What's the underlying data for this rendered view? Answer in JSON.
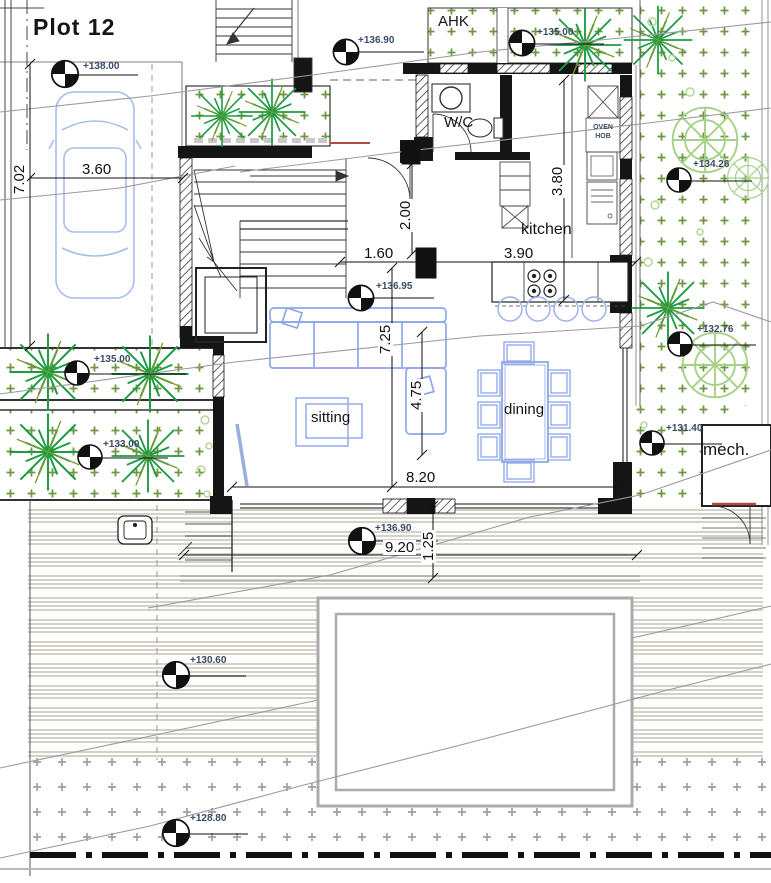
{
  "title": "Plot 12",
  "rooms": {
    "ahk": "AHK",
    "wc": "W/C",
    "kitchen": "kitchen",
    "sitting": "sitting",
    "dining": "dining",
    "mech": "mech."
  },
  "appliance_labels": {
    "oven": "OVEN",
    "hob": "HOB"
  },
  "elevation_markers": [
    {
      "id": "garage",
      "value": "+138.00"
    },
    {
      "id": "entry-court",
      "value": "+136.90"
    },
    {
      "id": "ahk-court",
      "value": "+135.00"
    },
    {
      "id": "living",
      "value": "+136.95"
    },
    {
      "id": "garden-east-upper",
      "value": "+134.26"
    },
    {
      "id": "garden-east-mid",
      "value": "+132.76"
    },
    {
      "id": "mech-yard",
      "value": "+131.40"
    },
    {
      "id": "garden-west-upper",
      "value": "+135.00"
    },
    {
      "id": "garden-west-lower",
      "value": "+133.00"
    },
    {
      "id": "terrace",
      "value": "+136.90"
    },
    {
      "id": "lawn",
      "value": "+130.60"
    },
    {
      "id": "garden-south",
      "value": "+128.80"
    }
  ],
  "dimensions": [
    {
      "id": "plot-side",
      "value": "7.02"
    },
    {
      "id": "garage-width",
      "value": "3.60"
    },
    {
      "id": "entry-hall",
      "value": "2.00"
    },
    {
      "id": "kitchen-depth",
      "value": "3.80"
    },
    {
      "id": "hall-width",
      "value": "1.60"
    },
    {
      "id": "kitchen-width",
      "value": "3.90"
    },
    {
      "id": "living-depth",
      "value": "7.25"
    },
    {
      "id": "dining-depth",
      "value": "4.75"
    },
    {
      "id": "living-width",
      "value": "8.20"
    },
    {
      "id": "terrace-width",
      "value": "9.20"
    },
    {
      "id": "terrace-step",
      "value": "1.25"
    }
  ],
  "colors": {
    "wall": "#151515",
    "furniture_blue": "#8fa6e8",
    "tree_green": "#1c9c44",
    "tree_light_green": "#a5d287",
    "grass_cross_green": "#6f9640",
    "grass_cross_gray": "#9f9f9f",
    "marker_text": "#3b4a66",
    "contour_gray": "#9b9b9b",
    "accent_red": "#b24a44",
    "deck_stripe": "#d4d0ca",
    "pool_border": "#ababab"
  }
}
